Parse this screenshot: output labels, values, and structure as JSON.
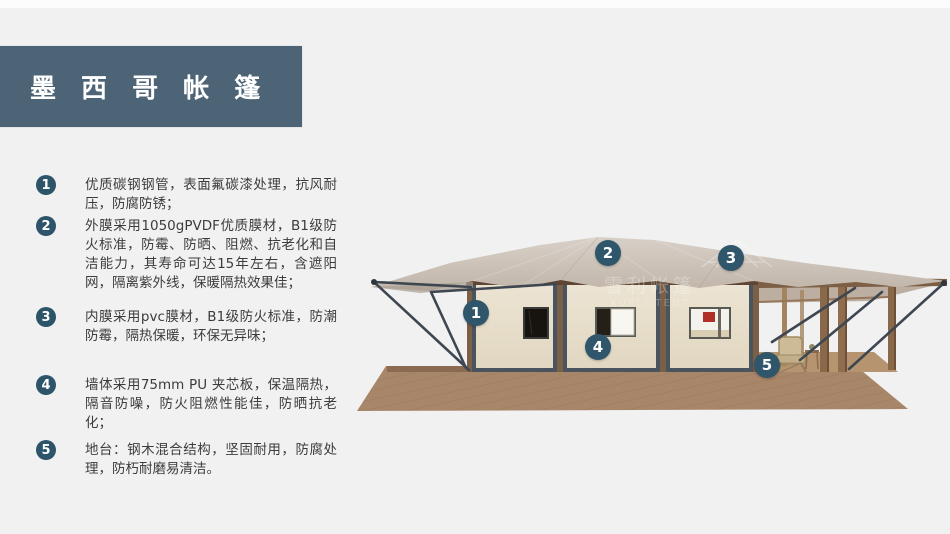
{
  "header": {
    "title": "墨 西 哥 帐 篷"
  },
  "features": [
    {
      "num": "1",
      "text": "优质碳钢钢管，表面氟碳漆处理，抗风耐压，防腐防锈；"
    },
    {
      "num": "2",
      "text": "外膜采用1050gPVDF优质膜材，B1级防火标准，防霉、防晒、阻燃、抗老化和自洁能力，其寿命可达15年左右，含遮阳网，隔离紫外线，保暖隔热效果佳；"
    },
    {
      "num": "3",
      "text": "内膜采用pvc膜材，B1级防火标准，防潮防霉，隔热保暖，环保无异味；"
    },
    {
      "num": "4",
      "text": "墙体采用75mm PU 夹芯板，保温隔热，隔音防噪，防火阻燃性能佳，防晒抗老化；"
    },
    {
      "num": "5",
      "text": "地台：钢木混合结构，坚固耐用，防腐处理，防朽耐磨易清洁。"
    }
  ],
  "tent": {
    "callouts": [
      {
        "num": "1",
        "x": 476,
        "y": 313
      },
      {
        "num": "2",
        "x": 608,
        "y": 253
      },
      {
        "num": "3",
        "x": 731,
        "y": 258
      },
      {
        "num": "4",
        "x": 598,
        "y": 347
      },
      {
        "num": "5",
        "x": 767,
        "y": 365
      }
    ],
    "watermark": {
      "cn": "雪利帐篷",
      "en": "XUELI TENT"
    }
  },
  "colors": {
    "header_bg": "#4d6477",
    "accent_circle": "#2e546a",
    "body_text": "#3c3c3c",
    "background": "#f1f1f2",
    "roof": "#cbc0b5",
    "wall": "#eae2cf",
    "frame": "#4a545f",
    "deck_wood": "#a8866a",
    "rod": "#3e4751"
  }
}
